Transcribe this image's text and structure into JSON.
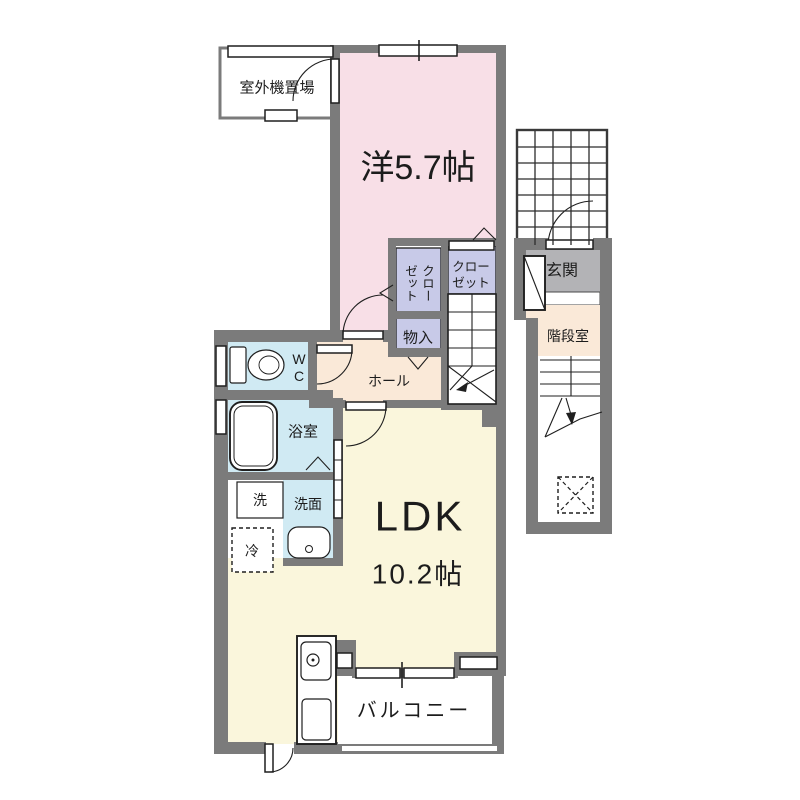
{
  "colors": {
    "wall": "#7b7b7b",
    "line": "#1f1f1f",
    "western_room": "#f8dfe7",
    "ldk": "#faf6dc",
    "hall": "#fae9d8",
    "wet_room": "#d0eaf3",
    "closet": "#c8cae8",
    "entrance": "#b3b3b6"
  },
  "labels": {
    "outdoor_unit": "室外機置場",
    "western_room": "洋5.7帖",
    "closet_v_col1": "クロー",
    "closet_v_col2": "ゼット",
    "closet_h_line1": "クロー",
    "closet_h_line2": "ゼット",
    "storage": "物入",
    "hall": "ホール",
    "wc_line1": "W",
    "wc_line2": "C",
    "bathroom": "浴室",
    "laundry": "洗",
    "washroom": "洗面",
    "fridge": "冷",
    "ldk_name": "LDK",
    "ldk_size": "10.2帖",
    "balcony": "バルコニー",
    "entrance": "玄関",
    "stairwell": "階段室"
  }
}
